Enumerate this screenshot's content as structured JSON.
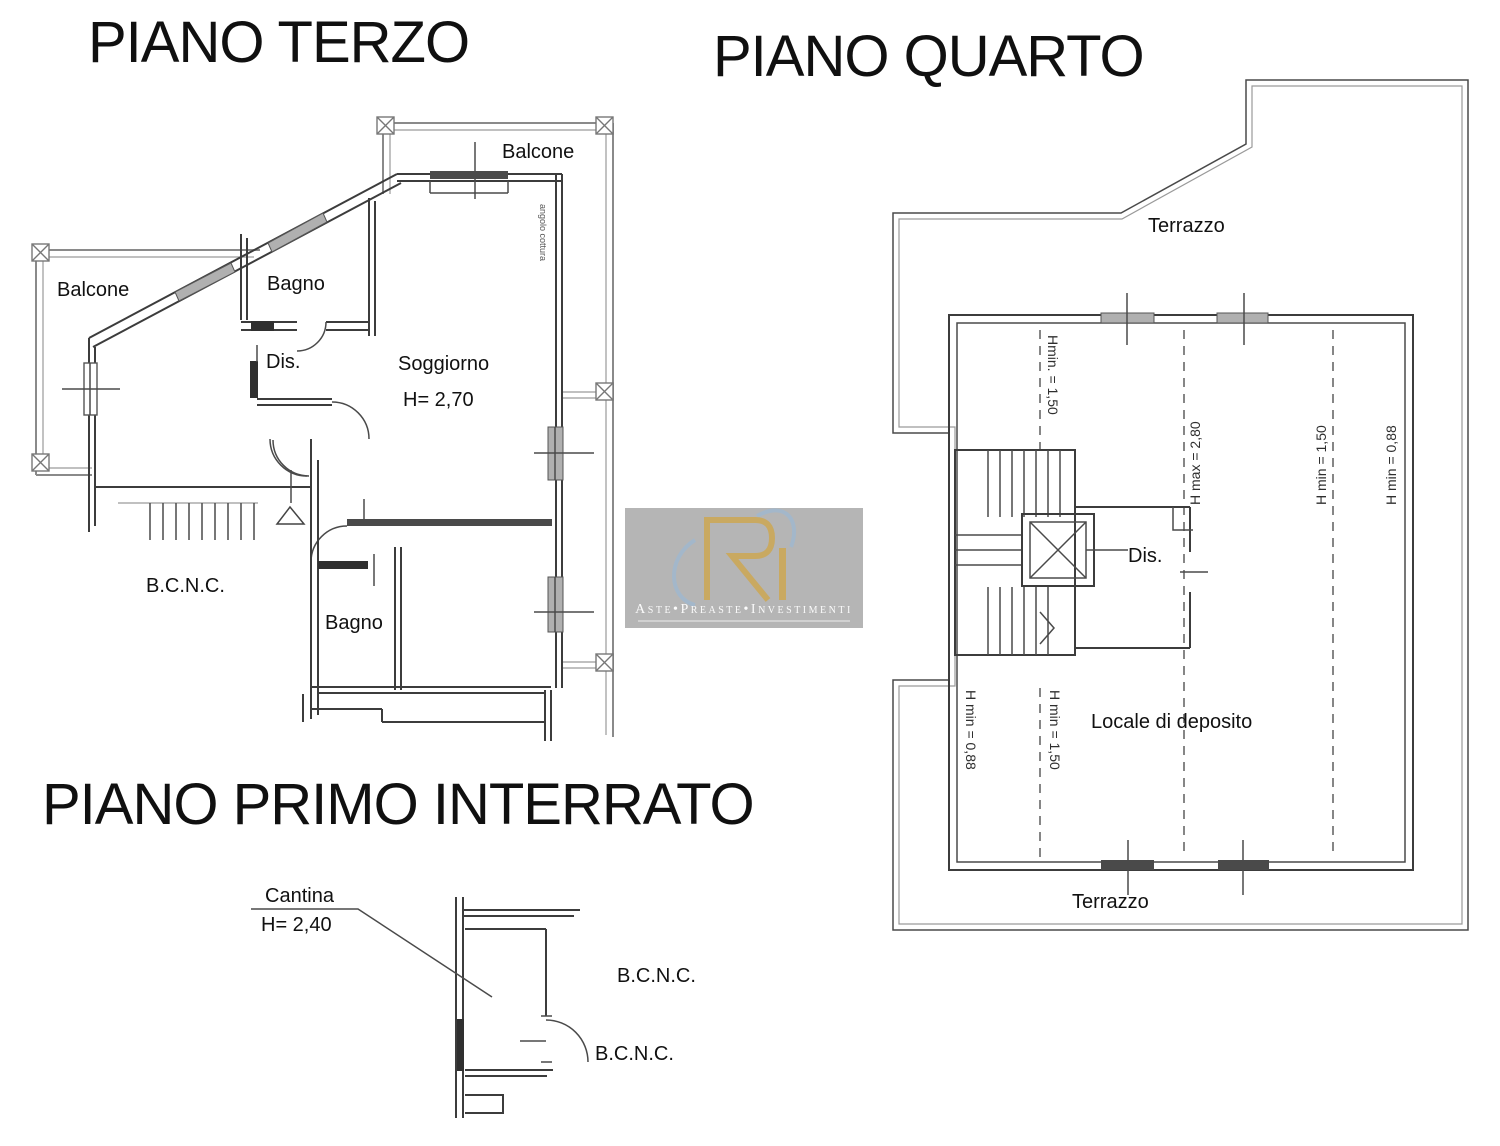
{
  "document": {
    "kind": "cadastral floor plan sheet"
  },
  "colors": {
    "background": "#ffffff",
    "wall_dark": "#3c3c3c",
    "wall_gray": "#8a8a8a",
    "window_fill": "#b0b0b0",
    "dashed_line": "#5e5e5e",
    "text": "#111111",
    "watermark_bg": "#b5b5b5",
    "watermark_gold": "#c9a961",
    "watermark_blue": "#9db8d2",
    "watermark_text": "#fbfbfb"
  },
  "titles": {
    "third_floor": "PIANO TERZO",
    "fourth_floor": "PIANO QUARTO",
    "basement": "PIANO PRIMO INTERRATO"
  },
  "third_floor": {
    "balcony_top": "Balcone",
    "balcony_left": "Balcone",
    "bathroom_upper": "Bagno",
    "hallway": "Dis.",
    "living_room": "Soggiorno",
    "living_room_height": "H= 2,70",
    "kitchen_corner": "angolo cottura",
    "common_area": "B.C.N.C.",
    "bathroom_lower": "Bagno"
  },
  "fourth_floor": {
    "terrace_top": "Terrazzo",
    "terrace_bottom": "Terrazzo",
    "hallway": "Dis.",
    "storage_room": "Locale di deposito",
    "height_upper_left": "Hmin. = 1,50",
    "height_max": "H max = 2,80",
    "height_min_center": "H min = 1,50",
    "height_min_right": "H min = 0,88",
    "height_min_lower_left": "H min = 0,88",
    "height_min_lower_center": "H min = 1,50"
  },
  "basement": {
    "cellar": "Cantina",
    "cellar_height": "H= 2,40",
    "common_area_1": "B.C.N.C.",
    "common_area_2": "B.C.N.C."
  },
  "watermark": {
    "caption": "Aste•Preaste•Investimenti"
  }
}
